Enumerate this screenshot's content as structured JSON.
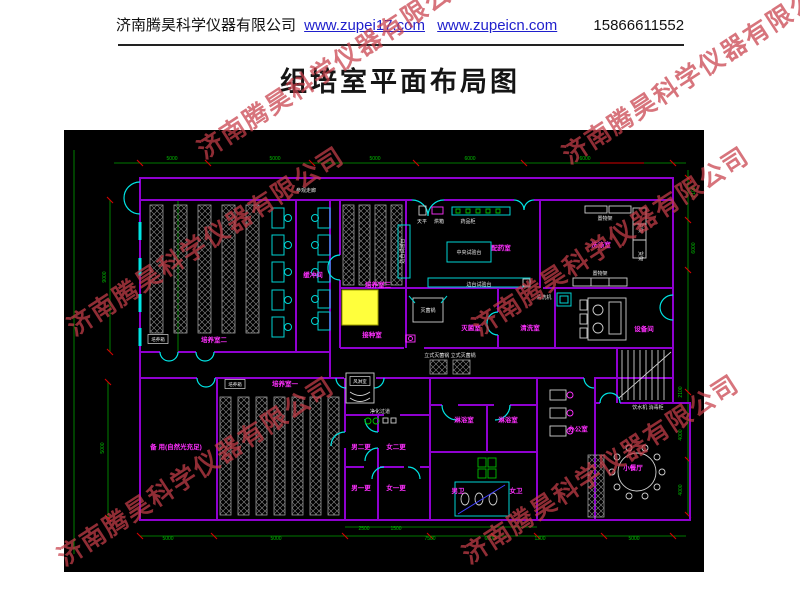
{
  "header": {
    "company": "济南腾昊科学仪器有限公司",
    "link1": "www.zupei17.com",
    "link2": "www.zupeicn.com",
    "phone": "15866611552"
  },
  "title": "组培室平面布局图",
  "watermark": {
    "text": "济南腾昊科学仪器有限公司"
  },
  "colors": {
    "wall": "#8F00D0",
    "door": "#00E5E5",
    "dimension": "#00C000",
    "room_text": "#FF2FFF",
    "equipment_text": "#E8E8E8",
    "highlight": "#FFFF3C",
    "watermark": "#C73E4A",
    "link": "#1F1FCC"
  },
  "plan": {
    "room_labels": [
      {
        "t": "参观走廊",
        "x": 242,
        "y": 62,
        "cls": "wh",
        "fs": 6
      },
      {
        "t": "培养室二",
        "x": 150,
        "y": 212
      },
      {
        "t": "缓冲间",
        "x": 249,
        "y": 147,
        "fs": 5.5
      },
      {
        "t": "培养室三",
        "x": 314,
        "y": 157
      },
      {
        "t": "接种室",
        "x": 308,
        "y": 207
      },
      {
        "t": "配药室",
        "x": 437,
        "y": 120
      },
      {
        "t": "洗涤室",
        "x": 537,
        "y": 117
      },
      {
        "t": "灭菌室",
        "x": 407,
        "y": 200
      },
      {
        "t": "清洗室",
        "x": 466,
        "y": 200
      },
      {
        "t": "设备间",
        "x": 580,
        "y": 201
      },
      {
        "t": "培养室一",
        "x": 221,
        "y": 256
      },
      {
        "t": "备 用(自然光充足)",
        "x": 112,
        "y": 319,
        "fs": 5.5
      },
      {
        "t": "净化过道",
        "x": 316,
        "y": 283,
        "cls": "wh",
        "fs": 4.5
      },
      {
        "t": "男二更",
        "x": 297,
        "y": 319,
        "fs": 5.5
      },
      {
        "t": "女二更",
        "x": 332,
        "y": 319,
        "fs": 5.5
      },
      {
        "t": "男一更",
        "x": 297,
        "y": 360,
        "fs": 5.5
      },
      {
        "t": "女一更",
        "x": 332,
        "y": 360,
        "fs": 5.5
      },
      {
        "t": "淋浴室",
        "x": 400,
        "y": 292,
        "fs": 5.5
      },
      {
        "t": "淋浴室",
        "x": 444,
        "y": 292,
        "fs": 5.5
      },
      {
        "t": "男卫",
        "x": 394,
        "y": 363,
        "fs": 5.5
      },
      {
        "t": "女卫",
        "x": 452,
        "y": 363,
        "fs": 5.5
      },
      {
        "t": "办公室",
        "x": 514,
        "y": 301,
        "fs": 5.5
      },
      {
        "t": "小餐厅",
        "x": 569,
        "y": 340
      }
    ],
    "equipment_labels": [
      {
        "t": "天平",
        "x": 358,
        "y": 93
      },
      {
        "t": "烘箱",
        "x": 375,
        "y": 93
      },
      {
        "t": "药品柜",
        "x": 404,
        "y": 93
      },
      {
        "t": "中央试验台",
        "x": 405,
        "y": 124
      },
      {
        "t": "边台试验台",
        "x": 415,
        "y": 156
      },
      {
        "t": "边台试验台",
        "x": 340,
        "y": 121,
        "r": -90,
        "fs": 4.5
      },
      {
        "t": "灭菌锅",
        "x": 364,
        "y": 182
      },
      {
        "t": "立式灭菌锅 立式灭菌锅",
        "x": 386,
        "y": 227,
        "fs": 4.5
      },
      {
        "t": "清洗机",
        "x": 480,
        "y": 169,
        "fs": 4.5
      },
      {
        "t": "置物架",
        "x": 541,
        "y": 90,
        "fs": 4.5
      },
      {
        "t": "置物架",
        "x": 536,
        "y": 145,
        "fs": 4.5
      },
      {
        "t": "货架",
        "x": 575,
        "y": 98,
        "r": 90,
        "fs": 4
      },
      {
        "t": "货架",
        "x": 575,
        "y": 126,
        "r": 90,
        "fs": 4
      },
      {
        "t": "饮水机 消毒柜",
        "x": 584,
        "y": 279,
        "fs": 4.5
      },
      {
        "t": "风淋室",
        "x": 296,
        "y": 253,
        "cls": "box"
      },
      {
        "t": "培养箱",
        "x": 94,
        "y": 211,
        "cls": "box"
      },
      {
        "t": "培养箱",
        "x": 171,
        "y": 256,
        "cls": "box"
      }
    ],
    "dimension_labels": [
      {
        "t": "5000",
        "x": 108,
        "y": 30
      },
      {
        "t": "5000",
        "x": 211,
        "y": 30
      },
      {
        "t": "5000",
        "x": 311,
        "y": 30
      },
      {
        "t": "6000",
        "x": 406,
        "y": 30
      },
      {
        "t": "6000",
        "x": 521,
        "y": 30
      },
      {
        "t": "2100",
        "x": 631,
        "y": 62,
        "r": -90
      },
      {
        "t": "6000",
        "x": 631,
        "y": 118,
        "r": -90
      },
      {
        "t": "2100",
        "x": 618,
        "y": 262,
        "r": -90
      },
      {
        "t": "4000",
        "x": 618,
        "y": 305,
        "r": -90
      },
      {
        "t": "4000",
        "x": 618,
        "y": 360,
        "r": -90
      },
      {
        "t": "9000",
        "x": 42,
        "y": 147,
        "r": -90
      },
      {
        "t": "5000",
        "x": 40,
        "y": 318,
        "r": -90
      },
      {
        "t": "2500",
        "x": 300,
        "y": 400
      },
      {
        "t": "1500",
        "x": 332,
        "y": 400
      },
      {
        "t": "5000",
        "x": 104,
        "y": 410
      },
      {
        "t": "5000",
        "x": 212,
        "y": 410
      },
      {
        "t": "7500",
        "x": 366,
        "y": 410
      },
      {
        "t": "6000",
        "x": 426,
        "y": 410
      },
      {
        "t": "1200",
        "x": 476,
        "y": 410
      },
      {
        "t": "5000",
        "x": 570,
        "y": 410
      }
    ]
  }
}
